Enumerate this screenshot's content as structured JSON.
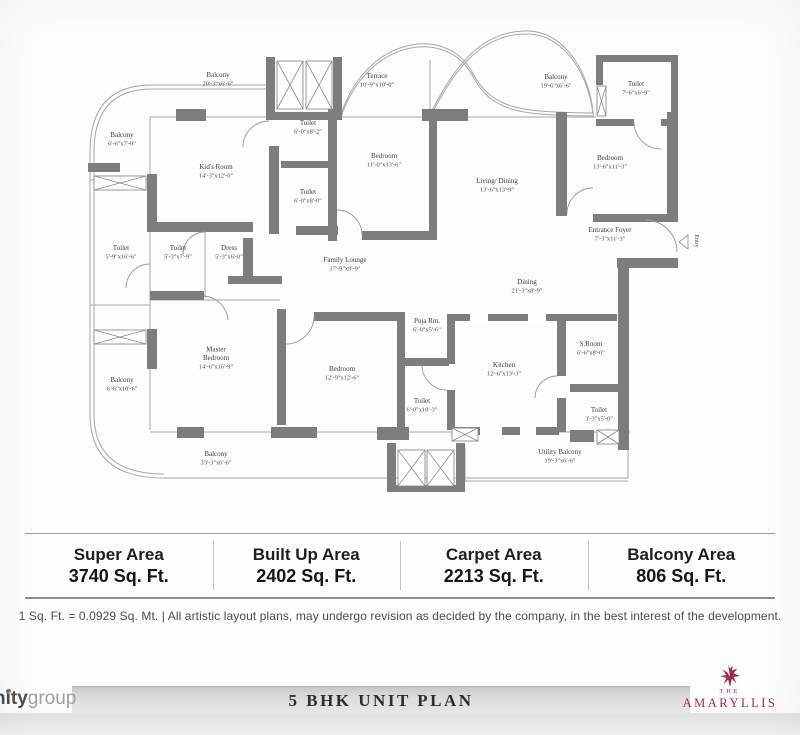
{
  "plan": {
    "rooms": [
      {
        "x": 218,
        "y": 81,
        "lines": [
          "Balcony",
          "20'-3\"x6'-6\""
        ]
      },
      {
        "x": 377,
        "y": 82,
        "lines": [
          "Terrace",
          "10'-9\"x10'-0\""
        ]
      },
      {
        "x": 556,
        "y": 83,
        "lines": [
          "Balcony",
          "19'-6\"x6'-6\""
        ]
      },
      {
        "x": 636,
        "y": 90,
        "lines": [
          "Toilet",
          "7'-6\"x6'-9\""
        ]
      },
      {
        "x": 122,
        "y": 141,
        "lines": [
          "Balcony",
          "6'-6\"x7'-0\""
        ]
      },
      {
        "x": 216,
        "y": 173,
        "lines": [
          "Kid's Room",
          "14'-3\"x12'-0\""
        ]
      },
      {
        "x": 308,
        "y": 129,
        "lines": [
          "Toilet",
          "6'-0\"x8'-2\""
        ]
      },
      {
        "x": 308,
        "y": 198,
        "lines": [
          "Toilet",
          "6'-0\"x8'-0\""
        ]
      },
      {
        "x": 384,
        "y": 162,
        "lines": [
          "Bedroom",
          "11'-0\"x13'-6\""
        ]
      },
      {
        "x": 497,
        "y": 187,
        "lines": [
          "Living/ Dining",
          "13'-6\"x13'-9\""
        ]
      },
      {
        "x": 610,
        "y": 164,
        "lines": [
          "Bedroom",
          "13'-6\"x11'-3\""
        ]
      },
      {
        "x": 610,
        "y": 236,
        "lines": [
          "Entrance Foyer",
          "7'-3\"x11'-3\""
        ]
      },
      {
        "x": 121,
        "y": 254,
        "lines": [
          "Toilet",
          "5'-9\"x16'-6\""
        ]
      },
      {
        "x": 178,
        "y": 254,
        "lines": [
          "Toilet",
          "5'-3\"x7'-9\""
        ]
      },
      {
        "x": 229,
        "y": 254,
        "lines": [
          "Dress",
          "5'-3\"x6'-0\""
        ]
      },
      {
        "x": 345,
        "y": 266,
        "lines": [
          "Family Lounge",
          "17'-9\"x9'-9\""
        ]
      },
      {
        "x": 527,
        "y": 288,
        "lines": [
          "Dining",
          "21'-3\"x8'-9\""
        ]
      },
      {
        "x": 427,
        "y": 327,
        "lines": [
          "Puja Rm.",
          "6'-0\"x5'-6\""
        ]
      },
      {
        "x": 216,
        "y": 360,
        "lines": [
          "Master",
          "Bedroom",
          "14'-6\"x16'-9\""
        ]
      },
      {
        "x": 342,
        "y": 375,
        "lines": [
          "Bedroom",
          "12'-9\"x12'-6\""
        ]
      },
      {
        "x": 504,
        "y": 371,
        "lines": [
          "Kitchen",
          "12'-6\"x13'-3\""
        ]
      },
      {
        "x": 591,
        "y": 350,
        "lines": [
          "S.Room",
          "6'-6\"x8'-0\""
        ]
      },
      {
        "x": 422,
        "y": 407,
        "lines": [
          "Toilet",
          "6'-0\"x10'-3\""
        ]
      },
      {
        "x": 599,
        "y": 416,
        "lines": [
          "Toilet",
          "3'-3\"x5'-0\""
        ]
      },
      {
        "x": 122,
        "y": 386,
        "lines": [
          "Balcony",
          "6'-6\"x10'-6\""
        ]
      },
      {
        "x": 216,
        "y": 460,
        "lines": [
          "Balcony",
          "33'-3\"x6'-6\""
        ]
      },
      {
        "x": 560,
        "y": 458,
        "lines": [
          "Utility Balcony",
          "19'-3\"x6'-6\""
        ]
      },
      {
        "x": 695,
        "y": 241,
        "rot": 90,
        "small": true,
        "lines": [
          "Entry"
        ]
      }
    ]
  },
  "areas": [
    {
      "label": "Super Area",
      "value": "3740 Sq. Ft."
    },
    {
      "label": "Built Up Area",
      "value": "2402 Sq. Ft."
    },
    {
      "label": "Carpet Area",
      "value": "2213 Sq. Ft."
    },
    {
      "label": "Balcony Area",
      "value": "806 Sq. Ft."
    }
  ],
  "disclaimer": "1 Sq. Ft. = 0.0929 Sq. Mt. |  All artistic layout plans, may undergo revision as decided by the company, in the best interest of the development.",
  "footer": {
    "title": "5 BHK UNIT PLAN",
    "brand_left": {
      "bold": "nity",
      "light": "group"
    },
    "brand_right": {
      "the": "THE",
      "name": "AMARYLLIS"
    }
  },
  "colors": {
    "wall_gray": "#7d7d7d",
    "thin_line": "#a8a8a8",
    "brand_maroon": "#9b2d4e",
    "title_bar_gray": "#d9d9d9"
  }
}
